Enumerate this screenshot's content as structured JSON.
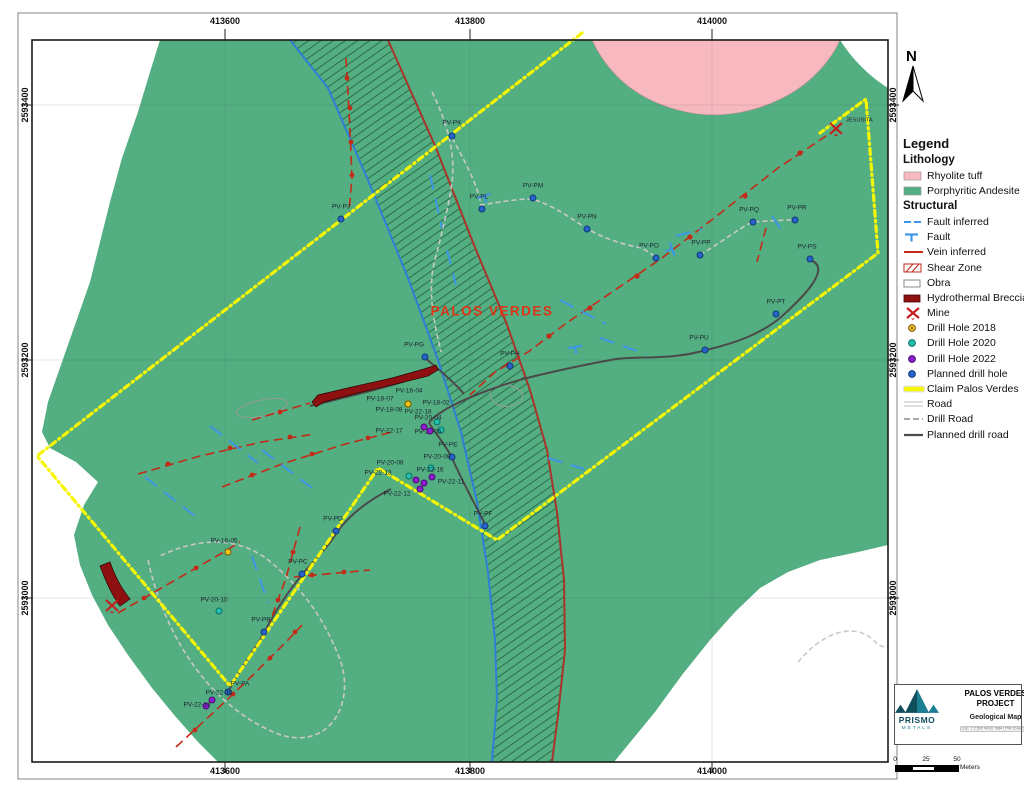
{
  "colors": {
    "andesite_green": "#53ae81",
    "rhyolite_pink": "#f7b9bf",
    "claim_yellow": "#f6f604",
    "vein_red": "#c42a18",
    "fault_blue": "#3e97e6",
    "shear_edge_blue": "#2f7fd6",
    "shear_edge_red": "#a8342a",
    "shear_hatch": "#0e3b23",
    "breccia_red": "#8f1010",
    "mine_red": "#c81d1d",
    "road_gray": "#c9c9c9",
    "drill_road_gray": "#9a9a9a",
    "planned_road_dark": "#4a4a4a",
    "dh2018_yellow": "#eec41d",
    "dh2020_teal": "#1fc0ad",
    "dh2022_purple": "#8d1fd0",
    "planned_blue": "#2763c9",
    "label_dark": "#1c2430",
    "region_red": "#e03418",
    "prismo_teal": "#0f4f5c",
    "prismo_teal_light": "#1b7f93"
  },
  "frame": {
    "coordinates": {
      "top": [
        {
          "label": "413600",
          "x": 225
        },
        {
          "label": "413800",
          "x": 470
        },
        {
          "label": "414000",
          "x": 712
        }
      ],
      "bottom": [
        {
          "label": "413600",
          "x": 225
        },
        {
          "label": "413800",
          "x": 470
        },
        {
          "label": "414000",
          "x": 712
        }
      ],
      "left": [
        {
          "label": "2593400",
          "y": 105
        },
        {
          "label": "2593200",
          "y": 360
        },
        {
          "label": "2593000",
          "y": 598
        }
      ],
      "right": [
        {
          "label": "2593400",
          "y": 105
        },
        {
          "label": "2593200",
          "y": 360
        },
        {
          "label": "2593000",
          "y": 598
        }
      ]
    }
  },
  "map": {
    "region_label": "PALOS VERDES",
    "mine_label": "JESUSITA",
    "drill_holes": [
      {
        "label": "PV-PK",
        "type": "planned",
        "x": 452,
        "y": 136,
        "lx": 452,
        "ly": 123
      },
      {
        "label": "PV-PJ",
        "type": "planned",
        "x": 341,
        "y": 219,
        "lx": 341,
        "ly": 207
      },
      {
        "label": "PV-PL",
        "type": "planned",
        "x": 482,
        "y": 209,
        "lx": 479,
        "ly": 197
      },
      {
        "label": "PV-PM",
        "type": "planned",
        "x": 533,
        "y": 198,
        "lx": 533,
        "ly": 186
      },
      {
        "label": "PV-PN",
        "type": "planned",
        "x": 587,
        "y": 229,
        "lx": 587,
        "ly": 217
      },
      {
        "label": "PV-PO",
        "type": "planned",
        "x": 656,
        "y": 258,
        "lx": 649,
        "ly": 246
      },
      {
        "label": "PV-PP",
        "type": "planned",
        "x": 700,
        "y": 255,
        "lx": 701,
        "ly": 243
      },
      {
        "label": "PV-PQ",
        "type": "planned",
        "x": 753,
        "y": 222,
        "lx": 749,
        "ly": 210
      },
      {
        "label": "PV-PR",
        "type": "planned",
        "x": 795,
        "y": 220,
        "lx": 797,
        "ly": 208
      },
      {
        "label": "PV-PS",
        "type": "planned",
        "x": 810,
        "y": 259,
        "lx": 807,
        "ly": 247
      },
      {
        "label": "PV-PT",
        "type": "planned",
        "x": 776,
        "y": 314,
        "lx": 776,
        "ly": 302
      },
      {
        "label": "PV-PU",
        "type": "planned",
        "x": 705,
        "y": 350,
        "lx": 699,
        "ly": 338
      },
      {
        "label": "PV-PG",
        "type": "planned",
        "x": 425,
        "y": 357,
        "lx": 414,
        "ly": 345
      },
      {
        "label": "PV-PH",
        "type": "planned",
        "x": 510,
        "y": 366,
        "lx": 510,
        "ly": 354
      },
      {
        "label": "PV-PE",
        "type": "planned",
        "x": 452,
        "y": 457,
        "lx": 448,
        "ly": 445
      },
      {
        "label": "PV-PF",
        "type": "planned",
        "x": 485,
        "y": 526,
        "lx": 483,
        "ly": 514
      },
      {
        "label": "PV-PD",
        "type": "planned",
        "x": 336,
        "y": 531,
        "lx": 333,
        "ly": 519
      },
      {
        "label": "PV-PC",
        "type": "planned",
        "x": 302,
        "y": 574,
        "lx": 298,
        "ly": 562
      },
      {
        "label": "PV-PB",
        "type": "planned",
        "x": 264,
        "y": 632,
        "lx": 261,
        "ly": 620
      },
      {
        "label": "PV-PA",
        "type": "planned",
        "x": 228,
        "y": 692,
        "lx": 240,
        "ly": 684
      },
      {
        "label": "PV-16-04",
        "type": "dh2018",
        "x": 408,
        "y": 404,
        "lx": 409,
        "ly": 391
      },
      {
        "label": "PV-18-07",
        "type": "dh2018",
        "x": 408,
        "y": 404,
        "lx": 380,
        "ly": 399
      },
      {
        "label": "PV-18-02",
        "type": "dh2018",
        "x": 408,
        "y": 404,
        "lx": 436,
        "ly": 403
      },
      {
        "label": "PV-18-08",
        "type": "dh2018",
        "x": 408,
        "y": 404,
        "lx": 389,
        "ly": 410
      },
      {
        "label": "PV-16-05",
        "type": "dh2018",
        "x": 228,
        "y": 552,
        "lx": 224,
        "ly": 541
      },
      {
        "label": "PV-20-04",
        "type": "dh2020",
        "x": 437,
        "y": 422,
        "lx": 428,
        "ly": 418
      },
      {
        "label": "PV-20-05",
        "type": "dh2020",
        "x": 441,
        "y": 430,
        "lx": 428,
        "ly": 432
      },
      {
        "label": "PV-20-08",
        "type": "dh2020",
        "x": 409,
        "y": 476,
        "lx": 390,
        "ly": 463
      },
      {
        "label": "PV-20-09",
        "type": "dh2020",
        "x": 431,
        "y": 468,
        "lx": 437,
        "ly": 457
      },
      {
        "label": "PV-20-10",
        "type": "dh2020",
        "x": 219,
        "y": 611,
        "lx": 214,
        "ly": 600
      },
      {
        "label": "PV-22-18",
        "type": "dh2022",
        "x": 424,
        "y": 427,
        "lx": 418,
        "ly": 412
      },
      {
        "label": "PV-22-17",
        "type": "dh2022",
        "x": 430,
        "y": 431,
        "lx": 389,
        "ly": 431
      },
      {
        "label": "PV-22-16",
        "type": "dh2022",
        "x": 424,
        "y": 483,
        "lx": 430,
        "ly": 470
      },
      {
        "label": "PV-22-13",
        "type": "dh2022",
        "x": 416,
        "y": 480,
        "lx": 378,
        "ly": 473
      },
      {
        "label": "PV-22-11",
        "type": "dh2022",
        "x": 432,
        "y": 477,
        "lx": 451,
        "ly": 482
      },
      {
        "label": "PV-22-12",
        "type": "dh2022",
        "x": 420,
        "y": 489,
        "lx": 397,
        "ly": 494
      },
      {
        "label": "PV-22-15",
        "type": "dh2022",
        "x": 212,
        "y": 700,
        "lx": 219,
        "ly": 693
      },
      {
        "label": "PV-22-14",
        "type": "dh2022",
        "x": 206,
        "y": 706,
        "lx": 197,
        "ly": 705
      }
    ]
  },
  "north_label": "N",
  "legend": {
    "title": "Legend",
    "sections": [
      {
        "heading": "Lithology",
        "items": [
          {
            "icon": "swatch-rhyolite",
            "label": "Rhyolite tuff"
          },
          {
            "icon": "swatch-andesite",
            "label": "Porphyritic Andesite"
          }
        ]
      },
      {
        "heading": "Structural",
        "items": [
          {
            "icon": "fault-inferred",
            "label": "Fault inferred"
          },
          {
            "icon": "fault",
            "label": "Fault"
          },
          {
            "icon": "vein-inferred",
            "label": "Vein inferred"
          },
          {
            "icon": "shear-zone",
            "label": "Shear Zone"
          },
          {
            "icon": "obra",
            "label": "Obra"
          },
          {
            "icon": "breccia",
            "label": "Hydrothermal Breccia"
          },
          {
            "icon": "mine",
            "label": "Mine"
          },
          {
            "icon": "dh-2018",
            "label": "Drill Hole 2018"
          },
          {
            "icon": "dh-2020",
            "label": "Drill Hole 2020"
          },
          {
            "icon": "dh-2022",
            "label": "Drill Hole 2022"
          },
          {
            "icon": "dh-planned",
            "label": "Planned drill hole"
          },
          {
            "icon": "claim",
            "label": "Claim Palos Verdes"
          },
          {
            "icon": "road",
            "label": "Road"
          },
          {
            "icon": "drill-road",
            "label": "Drill Road"
          },
          {
            "icon": "planned-drill-road",
            "label": "Planned drill road"
          }
        ]
      }
    ]
  },
  "title_block": {
    "company": "PRISMO",
    "company_sub": "METALS",
    "line1": "PALOS VERDES",
    "line2": "PROJECT",
    "subtitle": "Geological Map",
    "info_strip": "Esc. 1:2,500   WGS 1984 UTM Zone 13N"
  },
  "scale_bar": {
    "ticks": [
      "0",
      "25",
      "50"
    ],
    "unit": "Meters",
    "tick_x": [
      11,
      42,
      73
    ]
  }
}
